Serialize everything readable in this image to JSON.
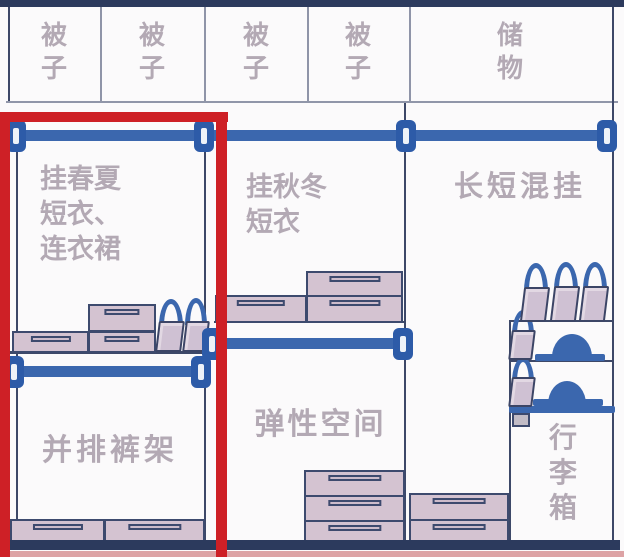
{
  "diagram_title": "wardrobe-organization-diagram",
  "top_shelf": {
    "cells": [
      {
        "label": "被\n子"
      },
      {
        "label": "被\n子"
      },
      {
        "label": "被\n子"
      },
      {
        "label": "被\n子"
      },
      {
        "label": "储\n物"
      }
    ]
  },
  "sections": {
    "left": {
      "hang_zone_label": "挂春夏\n短衣、\n连衣裙",
      "pants_zone_label": "并排裤架"
    },
    "middle": {
      "hang_zone_label": "挂秋冬\n短衣",
      "flex_zone_label": "弹性空间"
    },
    "right": {
      "hang_zone_label": "长短混挂",
      "luggage_zone_label": "行\n李\n箱"
    }
  },
  "colors": {
    "highlight_red": "#ce2026",
    "rod_blue": "#3b67ae",
    "bracket_blue": "#2d5ba8",
    "frame_navy": "#2c3a5d",
    "drawer_mauve": "#d4c3d1",
    "label_gray": "#b3a9b4",
    "floor_pink": "#dda3a5"
  }
}
